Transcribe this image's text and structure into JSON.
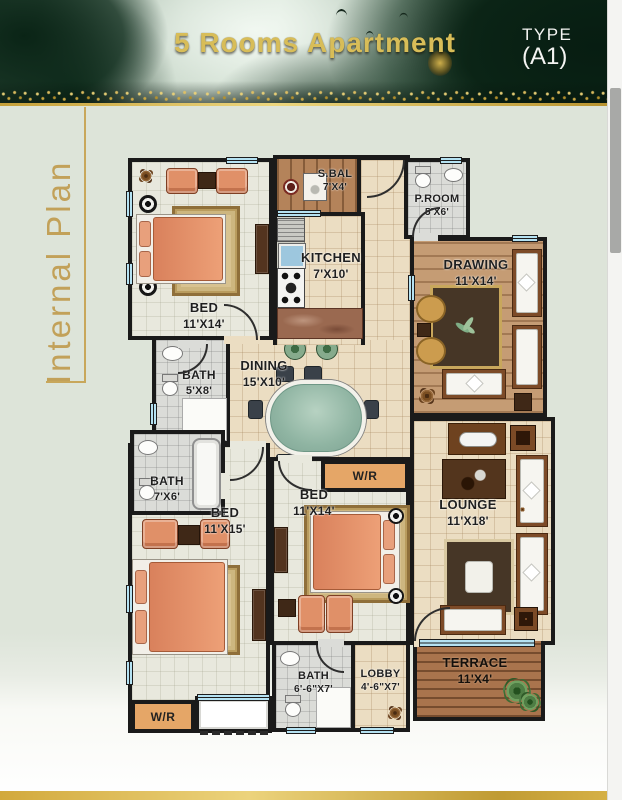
{
  "header": {
    "title": "5 Rooms Apartment",
    "type_label": "TYPE",
    "type_value": "(A1)"
  },
  "sidebar": {
    "label": "Internal Plan"
  },
  "colors": {
    "accent_gold": "#c8a75b",
    "header_green": "#0a2417",
    "page_bg": "#dde4d9",
    "wall_black": "#1a1a1a",
    "tile_beige": "#ebddc2",
    "tile_gray": "#dbdcd8",
    "wood_brown": "#b4835a",
    "furniture_orange": "#e09068",
    "wr_orange": "#e5a667",
    "table_teal": "#8fb4a2",
    "window_blue": "#b5e2f2"
  },
  "rooms": {
    "bed1": {
      "name": "BED",
      "size": "11'X14'"
    },
    "sbal": {
      "name": "S.BAL",
      "size": "7'X4'"
    },
    "kitchen": {
      "name": "KITCHEN",
      "size": "7'X10'"
    },
    "proom": {
      "name": "P.ROOM",
      "size": "5'X6'"
    },
    "drawing": {
      "name": "DRAWING",
      "size": "11'X14'"
    },
    "dining": {
      "name": "DINING",
      "size": "15'X10'"
    },
    "bath1": {
      "name": "BATH",
      "size": "5'X8'"
    },
    "bath2": {
      "name": "BATH",
      "size": "7'X6'"
    },
    "bed2": {
      "name": "BED",
      "size": "11'X15'"
    },
    "bed3": {
      "name": "BED",
      "size": "11'X14'"
    },
    "wr_bed3": {
      "name": "W/R"
    },
    "lounge": {
      "name": "LOUNGE",
      "size": "11'X18'"
    },
    "bath3": {
      "name": "BATH",
      "size": "6'-6\"X7'"
    },
    "lobby": {
      "name": "LOBBY",
      "size": "4'-6\"X7'"
    },
    "terrace": {
      "name": "TERRACE",
      "size": "11'X4'"
    },
    "wr_bed2": {
      "name": "W/R"
    }
  }
}
